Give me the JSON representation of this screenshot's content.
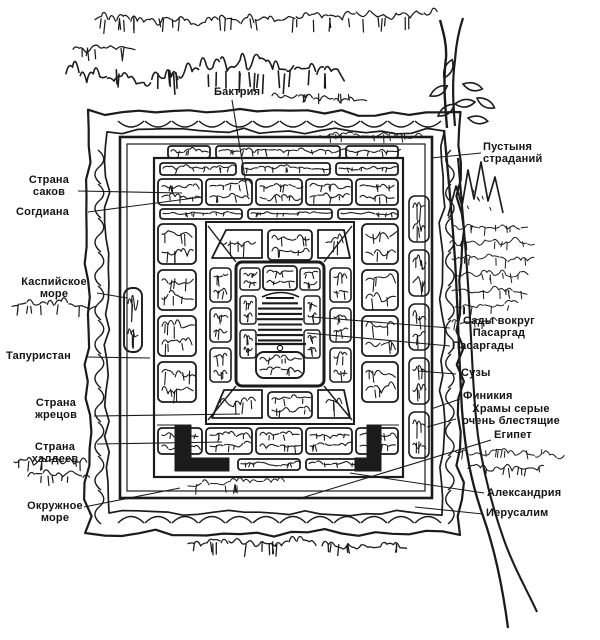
{
  "figure": {
    "kind": "scanned woodcut map with annotations"
  },
  "colors": {
    "ink": "#1b1b1b",
    "paper": "#ffffff"
  },
  "labels": {
    "baktria": "Бактрия",
    "desert": "Пустыня\nстраданий",
    "saka": "Страна\nсаков",
    "sogdiana": "Согдиана",
    "caspian": "Каспийское\nморе",
    "tapuristan": "Тапуристан",
    "gardens": "Сады вокруг\nПасаргад",
    "pasargadae": "Пасаргады",
    "susa": "Сузы",
    "phoenicia": "Финикия",
    "temples": "Храмы серые\nочень блестящие",
    "egypt": "Египет",
    "alexandria": "Александрия",
    "jerusalem": "Иерусалим",
    "priests": "Страна\nжрецов",
    "chaldeans": "Страна\nхалдеев",
    "sea": "Окружное\nморе"
  }
}
